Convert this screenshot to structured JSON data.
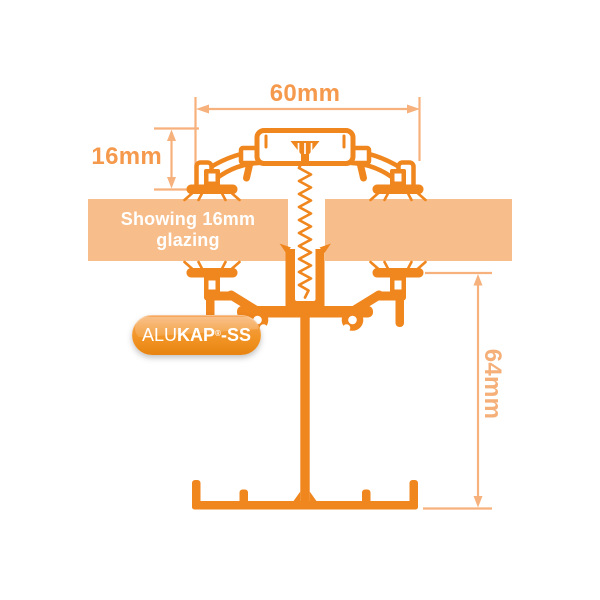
{
  "dimensions": {
    "width": "60mm",
    "glazing": "16mm",
    "height": "64mm"
  },
  "banner": {
    "text": "Showing 16mm glazing"
  },
  "logo": {
    "alu": "ALU",
    "kap": "KAP",
    "reg": "®",
    "ss": "-SS"
  },
  "colors": {
    "background": "#FFFFFF",
    "profile_orange": "#F0861E",
    "glazing_panel_fill": "#F7BE8B",
    "dimension_lines": "#F6B17C",
    "dimension_label": "#F5994D",
    "dimension_label_soft": "#F5AF79",
    "banner_text": "#FFFFFF",
    "logo_gradient_top": "#F6A557",
    "logo_gradient_bottom": "#E88410"
  }
}
